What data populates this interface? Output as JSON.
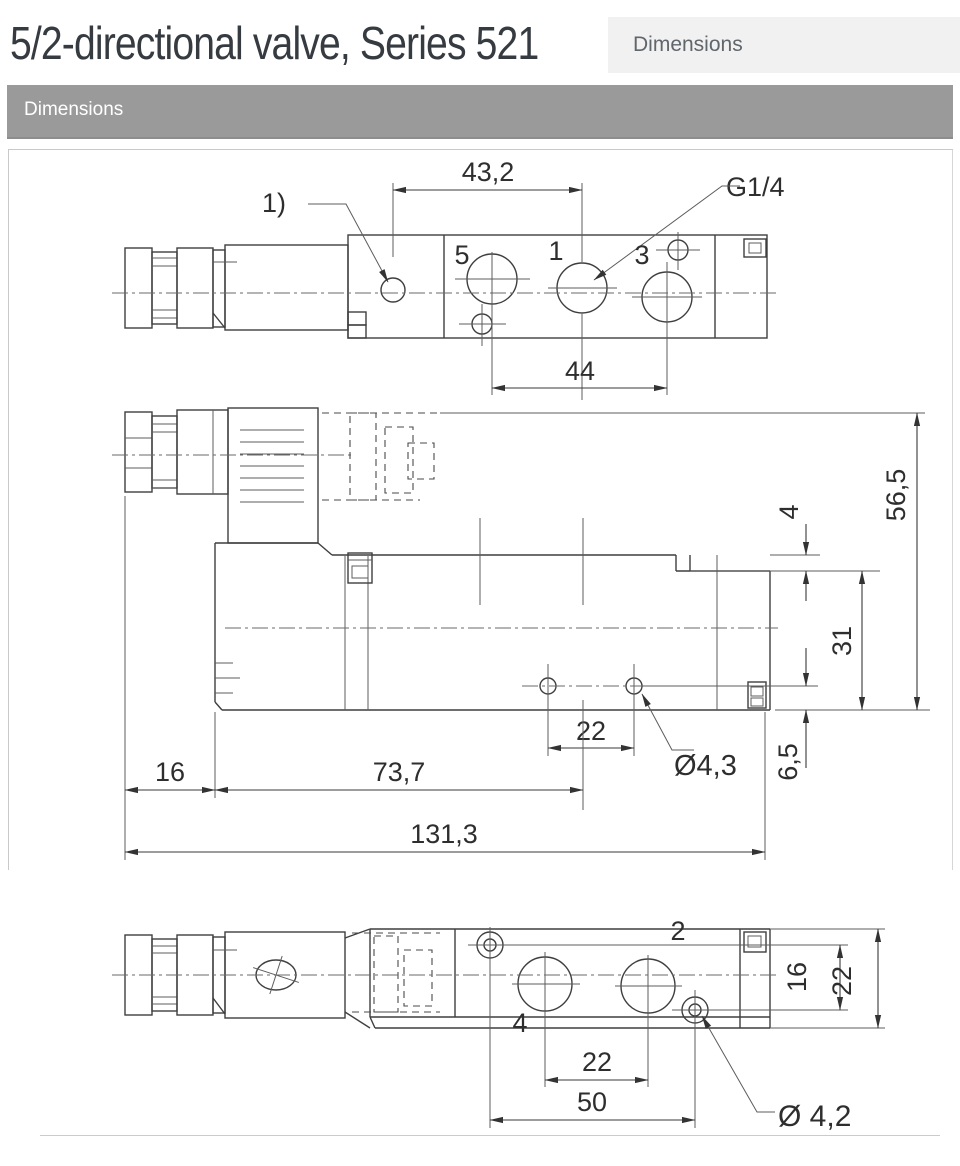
{
  "header": {
    "title": "5/2-directional valve, Series 521",
    "tab_label": "Dimensions"
  },
  "section_bar": {
    "label": "Dimensions"
  },
  "drawing": {
    "top_view": {
      "dim_width_top": "43,2",
      "note_ref": "1)",
      "thread_label": "G1/4",
      "port_5": "5",
      "port_1": "1",
      "port_3": "3",
      "dim_port_spacing": "44"
    },
    "side_view": {
      "dim_step": "4",
      "dim_total_height": "56,5",
      "dim_body_height": "31",
      "dim_hole_offset": "6,5",
      "dim_hole_spacing": "22",
      "hole_diameter": "Ø4,3",
      "dim_left_offset": "16",
      "dim_body_length": "73,7",
      "dim_total_length": "131,3"
    },
    "bottom_view": {
      "port_2": "2",
      "dim_height_inner": "16",
      "dim_height_outer": "22",
      "port_4": "4",
      "dim_port_spacing": "22",
      "dim_hole_spacing": "50",
      "hole_diameter": "Ø 4,2"
    }
  }
}
